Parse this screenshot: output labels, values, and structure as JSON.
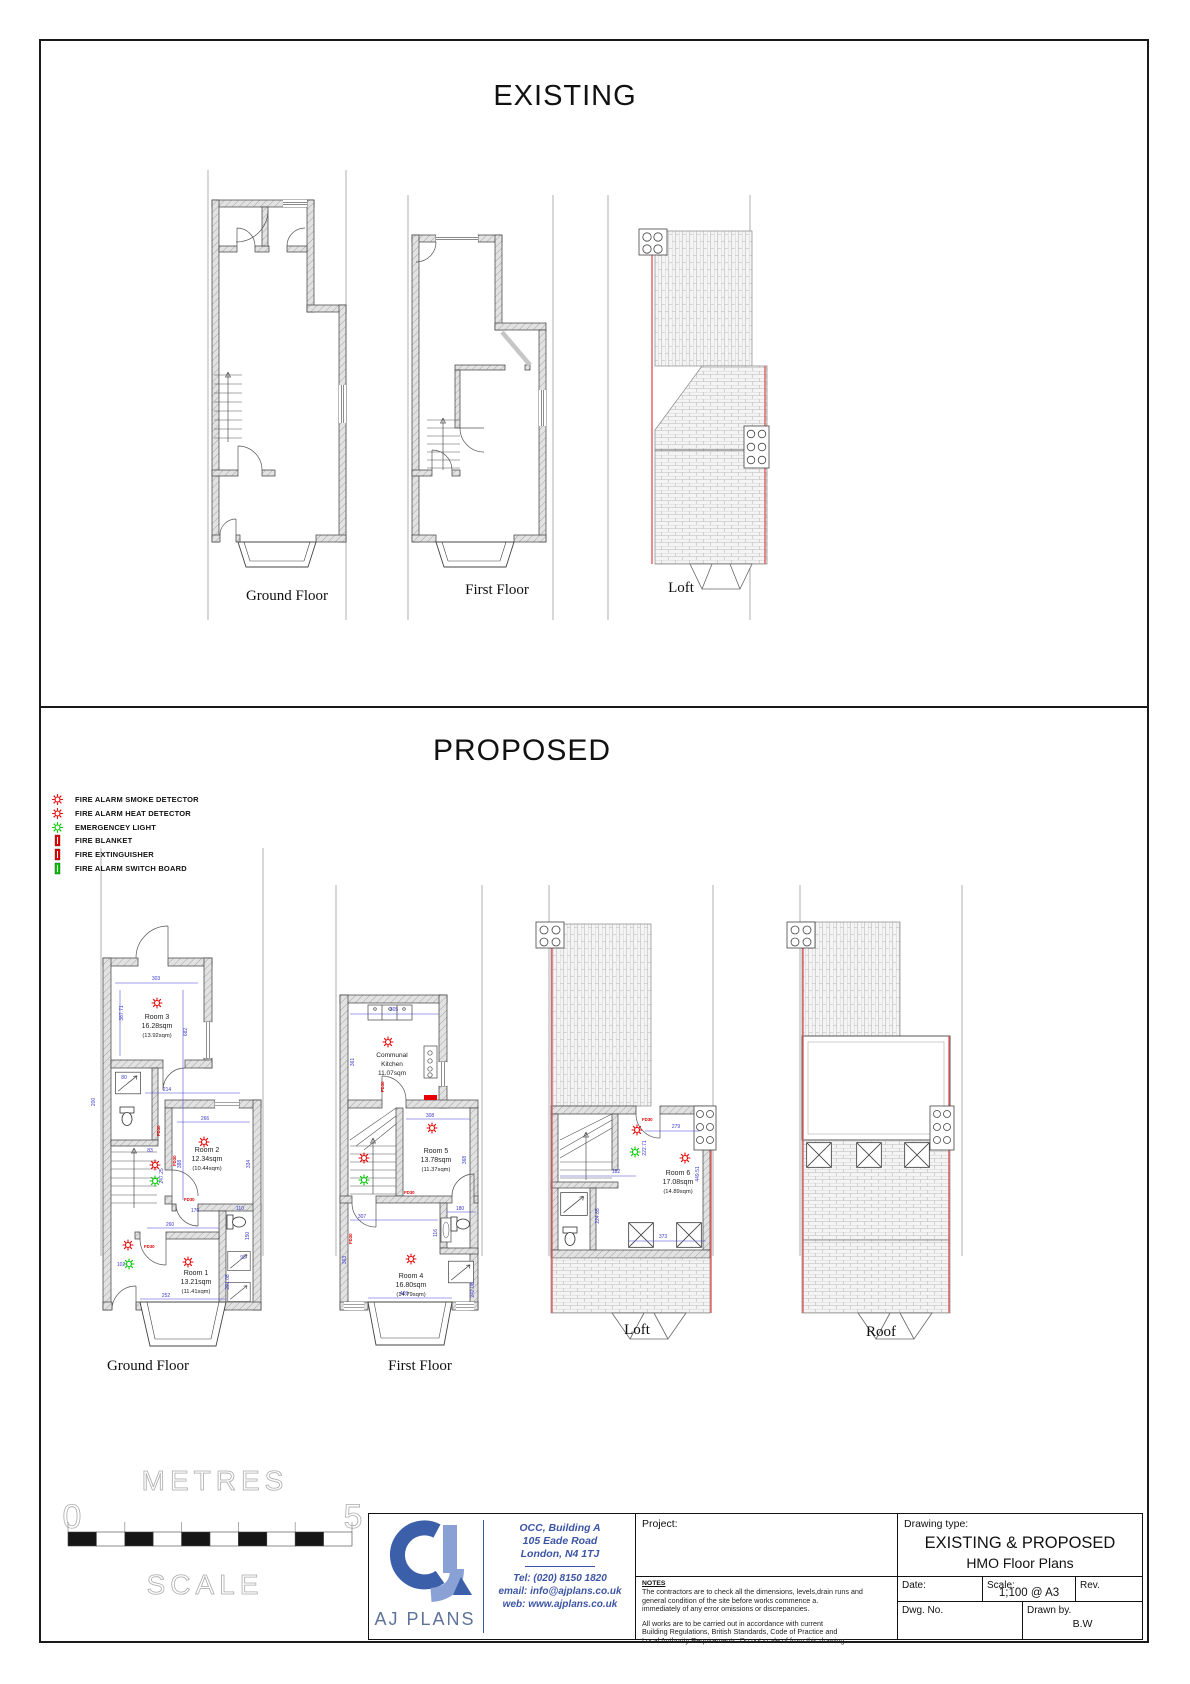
{
  "titles": {
    "existing": "EXISTING",
    "proposed": "PROPOSED"
  },
  "existing_labels": {
    "gf": "Ground Floor",
    "ff": "First Floor",
    "loft": "Loft"
  },
  "proposed_labels": {
    "gf": "Ground Floor",
    "ff": "First Floor",
    "loft": "Loft",
    "roof": "Roof"
  },
  "legend": {
    "items": [
      {
        "label": "FIRE ALARM SMOKE DETECTOR",
        "symbol": "sun-icon",
        "color": "#e80000"
      },
      {
        "label": "FIRE ALARM HEAT DETECTOR",
        "symbol": "sun-icon",
        "color": "#e80000"
      },
      {
        "label": "EMERGENCEY LIGHT",
        "symbol": "sun-icon",
        "color": "#00c800"
      },
      {
        "label": "FIRE BLANKET",
        "symbol": "rect-icon",
        "color": "#e80000"
      },
      {
        "label": "FIRE EXTINGUISHER",
        "symbol": "rect-icon",
        "color": "#e80000"
      },
      {
        "label": "FIRE ALARM SWITCH BOARD",
        "symbol": "rect-icon",
        "color": "#00c800"
      }
    ]
  },
  "fd30": "FD30",
  "pgf": {
    "room3": {
      "name": "Room 3",
      "area": "16.28sqm",
      "sub": "(13.92sqm)"
    },
    "room2": {
      "name": "Room 2",
      "area": "12.34sqm",
      "sub": "(10.44sqm)"
    },
    "room1": {
      "name": "Room 1",
      "area": "13.21sqm",
      "sub": "(11.41sqm)"
    },
    "dims": {
      "d303": "303",
      "d387": "387.71",
      "d682": "682",
      "d80": "80",
      "d200": "200",
      "d214": "214",
      "d266": "266",
      "d388": "388",
      "d334": "334",
      "d83": "83",
      "d247": "247.25",
      "d176": "176",
      "d110": "110",
      "d260": "260",
      "d102": "102",
      "d291": "291.08",
      "d150": "150",
      "d95": "95",
      "d252": "252"
    }
  },
  "pff": {
    "kitchen": {
      "l1": "Communal",
      "l2": "Kitchen",
      "l3": "11.07sqm"
    },
    "room5": {
      "name": "Room 5",
      "area": "13.78sqm",
      "sub": "(11.37sqm)"
    },
    "room4": {
      "name": "Room 4",
      "area": "16.80sqm",
      "sub": "(14.79sqm)"
    },
    "dims": {
      "d305": "305",
      "d361": "361",
      "d308": "308",
      "d368": "368",
      "d307": "307",
      "d363": "363",
      "d180": "180",
      "d116": "116",
      "d242": "242.08",
      "d409": "409"
    }
  },
  "ploft": {
    "room6": {
      "name": "Room 6",
      "area": "17.08sqm",
      "sub": "(14.89sqm)"
    },
    "dims": {
      "d279": "279",
      "d449": "449.51",
      "d182": "182",
      "d222": "222.71",
      "d224": "224.85",
      "d373": "373"
    }
  },
  "scalebar": {
    "units": "METRES",
    "zero": "0",
    "five": "5",
    "caption": "SCALE"
  },
  "titleblock": {
    "company": "AJ PLANS",
    "address1": "OCC, Building A",
    "address2": "105 Eade Road",
    "address3": "London, N4 1TJ",
    "tel": "Tel: (020) 8150 1820",
    "email": "email: info@ajplans.co.uk",
    "web": "web: www.ajplans.co.uk",
    "project_label": "Project:",
    "notes_title": "NOTES",
    "notes": [
      "The contractors are to check all the dimensions, levels,drain runs and",
      "general condition of the site before works commence a.",
      "immediately of any error omissions or discrepancies.",
      "All works are to be carried out in accordance with current",
      "Building Regulations, British Standards, Code of Practice and",
      "Local Authority Requirements. Do not scale of from this drawing."
    ],
    "drawing_type_label": "Drawing type:",
    "drawing_type1": "EXISTING & PROPOSED",
    "drawing_type2": "HMO Floor Plans",
    "date_label": "Date:",
    "scale_label": "Scale:",
    "scale_value": "1;100 @ A3",
    "rev_label": "Rev.",
    "dwg_label": "Dwg. No.",
    "drawn_label": "Drawn by.",
    "drawn_value": "B.W"
  }
}
